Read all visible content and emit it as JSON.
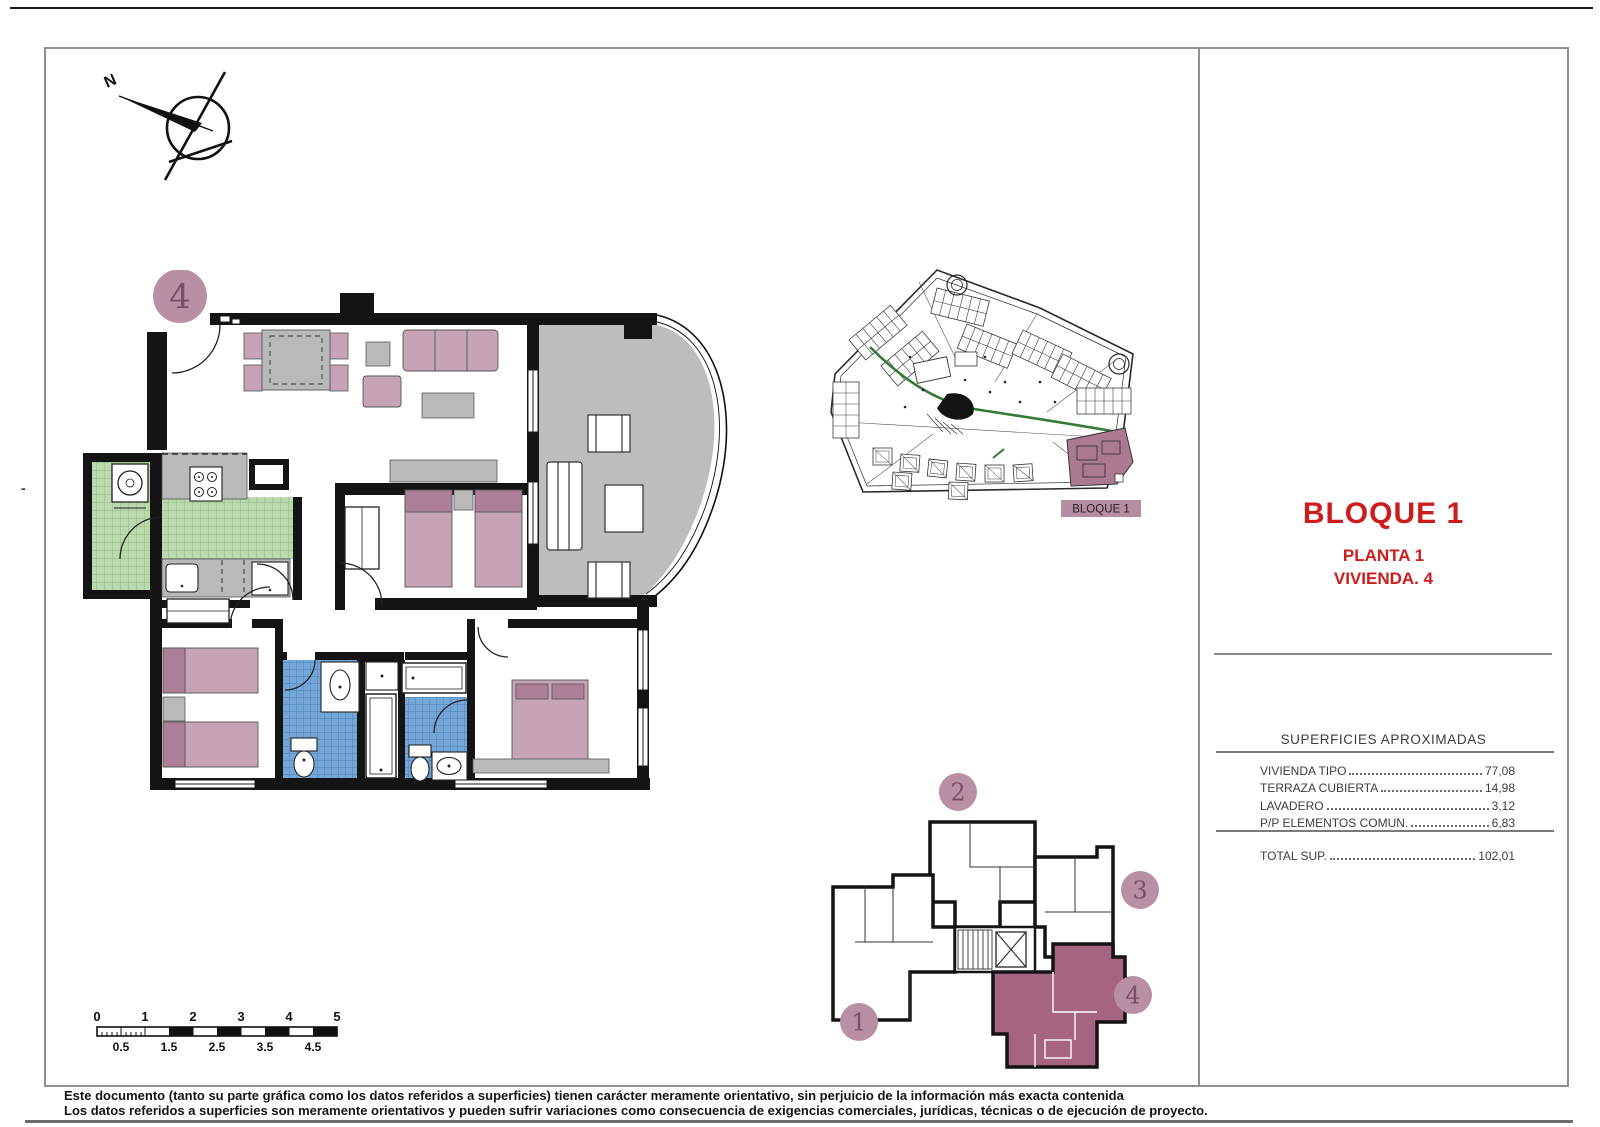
{
  "compass": {
    "north_label": "N"
  },
  "main_plan": {
    "unit_badge": "4"
  },
  "site_plan": {
    "block_label": "BLOQUE 1"
  },
  "key_plan": {
    "units": [
      "1",
      "2",
      "3",
      "4"
    ],
    "highlighted_unit": "4"
  },
  "title_block": {
    "title": "BLOQUE 1",
    "subtitle_floor": "PLANTA 1",
    "subtitle_unit": "VIVIENDA. 4"
  },
  "areas_table": {
    "header": "SUPERFICIES APROXIMADAS",
    "rows": [
      {
        "label": "VIVIENDA TIPO",
        "value": "77,08"
      },
      {
        "label": "TERRAZA CUBIERTA",
        "value": "14,98"
      },
      {
        "label": "LAVADERO",
        "value": "3,12"
      },
      {
        "label": "P/P ELEMENTOS COMUN.",
        "value": "6,83"
      }
    ],
    "total": {
      "label": "TOTAL SUP.",
      "value": "102,01"
    }
  },
  "scale_bar": {
    "top_labels": [
      "0",
      "1",
      "2",
      "3",
      "4",
      "5"
    ],
    "bottom_labels": [
      "0.5",
      "1.5",
      "2.5",
      "3.5",
      "4.5"
    ]
  },
  "disclaimer": {
    "line1": "Este documento (tanto su parte gráfica como los datos referidos a superficies) tienen carácter meramente orientativo, sin perjuicio de la información más exacta contenida",
    "line2": "Los datos referidos a superficies son meramente orientativos y pueden sufrir variaciones como consecuencia de exigencias comerciales, jurídicas, técnicas o de ejecución de proyecto."
  },
  "margin_mark": "-",
  "colors": {
    "accent_red": "#cc1c1c",
    "mauve_badge": "#b98fa4",
    "mauve_number": "#7d4e66",
    "unit_highlight": "#a5647f",
    "bed_pink": "#c6a4b6",
    "pillow_pink": "#ad7f97",
    "kitchen_green": "#bcd9ae",
    "bath_blue": "#74a7d8",
    "terrace_gray": "#bdbdbd"
  }
}
